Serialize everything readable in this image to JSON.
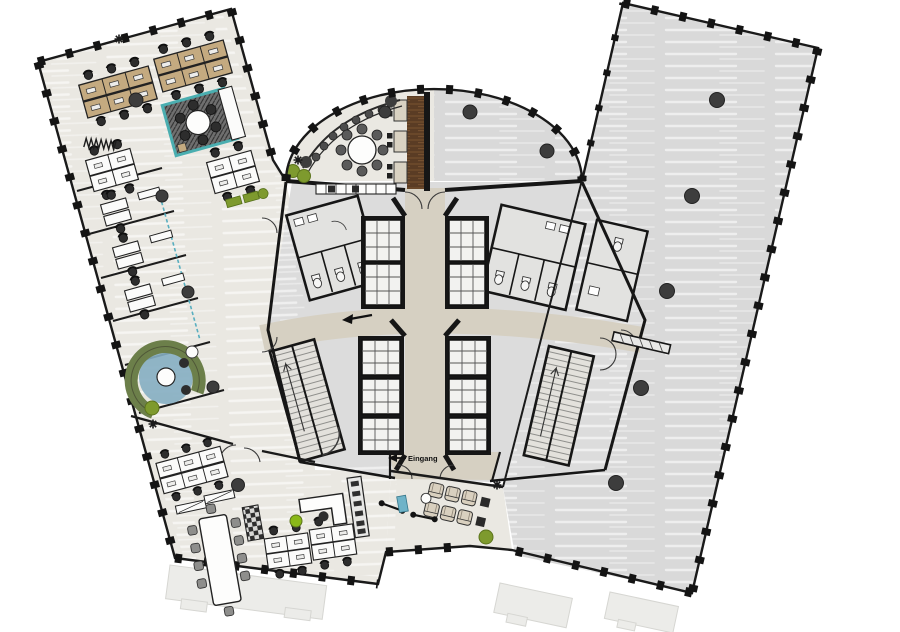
{
  "diagram": {
    "kind": "architectural-floor-plan",
    "labels": {
      "entrance": "Eingang"
    },
    "palette": {
      "background": "#ffffff",
      "wall": "#161616",
      "floor_furnished": "#eae8e2",
      "floor_vacant": "#d9d9d9",
      "floor_core": "#dcdcdc",
      "floor_corridor": "#d6d0c2",
      "desk_wood": "#c4aa80",
      "desk_white": "#fbfbfa",
      "accent_teal": "#4aaeb0",
      "accent_blue": "#85aec2",
      "plant_green": "#7e9a2e",
      "wood_dark": "#5a3c24",
      "column_gray": "#3d3d3d",
      "ghost_gray": "#ececE9"
    },
    "zones": {
      "left_wing": "open plan office wing with desk clusters, glass meeting room and cellular offices",
      "right_wing": "vacant unfurnished tenancy",
      "roof_terrace": "curved terrace, left half furnished with bar and booths",
      "core": "central core with lift banks, stairs and WCs",
      "bottom_band": "conference and team area",
      "lounge_wedge": "soft seating lounge with fitness corner"
    },
    "counts": {
      "lift_cells": 10,
      "stair_cores": 2,
      "columns_right_wing": 5,
      "wc_stalls_visible": 6
    }
  }
}
